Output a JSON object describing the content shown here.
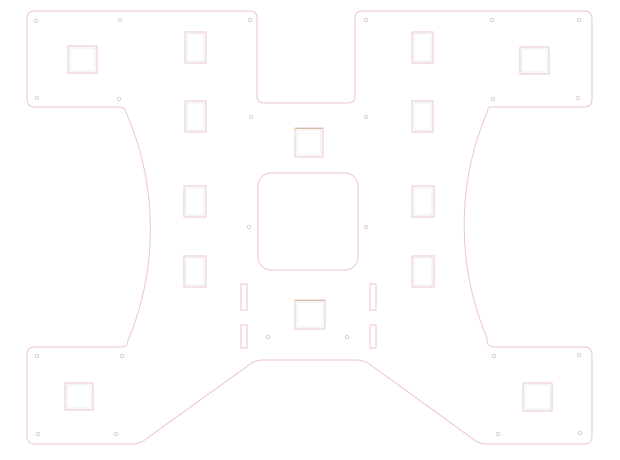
{
  "drawing": {
    "type": "cad-cut-template",
    "background": "#ffffff",
    "canvas": {
      "width": 620,
      "height": 460
    },
    "colors": {
      "outline": "#eec6c6",
      "inner_line": "#e9eef4",
      "tan_edge": "#d6bda0",
      "hole": "#d8cbcf"
    },
    "outline_path": "M 35,11 H 250 Q 257,11 257,18 V 96 Q 257,103 264,103 H 348 Q 355,103 355,96 V 18 Q 355,11 362,11 H 584 Q 592,11 592,19 V 99 Q 592,107 584,107 H 490 Q 488,107 487.6,111 A 290 290 0 0 0 487,338 Q 486.5,347 494,347 H 584 Q 592,347 592,355 V 436 Q 592,444 584,444 H 487 Q 480,444 475.5,440.8 L 369.5,364 Q 363,360 356,360 H 263 Q 256,360 251.5,363.2 L 143.5,440.8 Q 138,444 131,444 H 35 Q 27,444 27,436 V 355 Q 27,347 35,347 H 121 Q 127.5,347 127.8,341 A 290 290 0 0 0 125.4,111 Q 125,107 118,107 H 35 Q 27,107 27,99 V 19 Q 27,11 35,11 Z",
    "cutouts": {
      "rects": [
        {
          "kind": "corner-square",
          "x": 68,
          "y": 46,
          "w": 29,
          "h": 27,
          "inner": true
        },
        {
          "kind": "corner-square",
          "x": 520,
          "y": 47,
          "w": 29,
          "h": 27,
          "inner": true
        },
        {
          "kind": "corner-square",
          "x": 65,
          "y": 383,
          "w": 28,
          "h": 27,
          "inner": true
        },
        {
          "kind": "corner-square",
          "x": 523,
          "y": 383,
          "w": 29,
          "h": 28,
          "inner": true
        },
        {
          "kind": "column-rect",
          "x": 185,
          "y": 32,
          "w": 21,
          "h": 31,
          "inner": true
        },
        {
          "kind": "column-rect",
          "x": 185,
          "y": 101,
          "w": 21,
          "h": 31,
          "inner": true
        },
        {
          "kind": "column-rect",
          "x": 184,
          "y": 186,
          "w": 22,
          "h": 31,
          "inner": true
        },
        {
          "kind": "column-rect",
          "x": 184,
          "y": 256,
          "w": 22,
          "h": 31,
          "inner": true
        },
        {
          "kind": "column-rect",
          "x": 412,
          "y": 32,
          "w": 21,
          "h": 31,
          "inner": true
        },
        {
          "kind": "column-rect",
          "x": 412,
          "y": 101,
          "w": 21,
          "h": 31,
          "inner": true
        },
        {
          "kind": "column-rect",
          "x": 412,
          "y": 186,
          "w": 22,
          "h": 31,
          "inner": true
        },
        {
          "kind": "column-rect",
          "x": 412,
          "y": 256,
          "w": 22,
          "h": 31,
          "inner": true
        },
        {
          "kind": "center-square",
          "x": 295,
          "y": 128,
          "w": 28,
          "h": 29,
          "inner": true,
          "tan_top": true
        },
        {
          "kind": "center-window",
          "x": 258,
          "y": 173,
          "w": 100,
          "h": 97,
          "r": 13
        },
        {
          "kind": "center-square",
          "x": 295,
          "y": 300,
          "w": 30,
          "h": 29,
          "inner": true,
          "tan_top": true
        },
        {
          "kind": "slot",
          "x": 241,
          "y": 284,
          "w": 6,
          "h": 26
        },
        {
          "kind": "slot",
          "x": 241,
          "y": 325,
          "w": 6,
          "h": 23
        },
        {
          "kind": "slot",
          "x": 370,
          "y": 284,
          "w": 6,
          "h": 26
        },
        {
          "kind": "slot",
          "x": 370,
          "y": 325,
          "w": 6,
          "h": 23
        }
      ],
      "hole_radius": 1.7,
      "holes": [
        [
          36,
          21
        ],
        [
          120,
          20
        ],
        [
          250,
          20
        ],
        [
          366,
          20
        ],
        [
          492,
          20
        ],
        [
          579,
          20
        ],
        [
          37,
          98
        ],
        [
          119,
          99
        ],
        [
          251,
          117
        ],
        [
          366,
          117
        ],
        [
          493,
          99
        ],
        [
          578,
          98
        ],
        [
          249,
          227
        ],
        [
          366,
          227
        ],
        [
          268,
          337
        ],
        [
          347,
          337
        ],
        [
          37,
          356
        ],
        [
          122,
          356
        ],
        [
          494,
          356
        ],
        [
          579,
          355
        ],
        [
          38,
          434
        ],
        [
          116,
          434
        ],
        [
          498,
          434
        ],
        [
          580,
          433
        ]
      ]
    }
  }
}
